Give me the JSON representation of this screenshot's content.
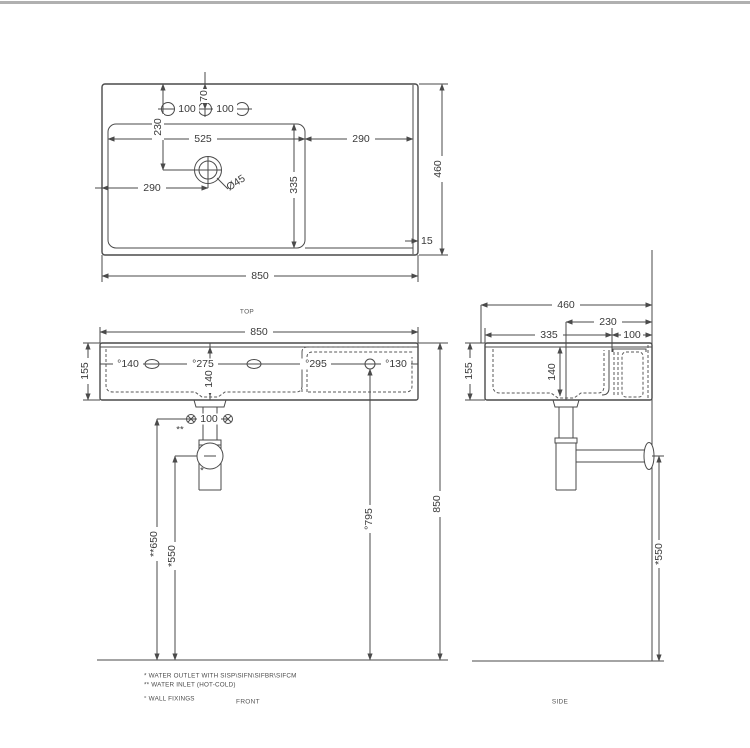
{
  "drawing": {
    "top_view": {
      "name": "TOP",
      "dims": {
        "tap_offset": "70",
        "tap_pitch_left": "100",
        "tap_pitch_right": "100",
        "drain_from_rear": "230",
        "bowl_width": "525",
        "deck_width": "290",
        "drain_from_left": "290",
        "drain_dia": "Ø45",
        "bowl_depth": "335",
        "overall_depth": "460",
        "rim": "15",
        "overall_width": "850"
      }
    },
    "front_view": {
      "name": "FRONT",
      "dims": {
        "overall_width": "850",
        "height": "155",
        "fix_left": "°140",
        "fix_pitch_left": "°275",
        "drain_drop": "140",
        "fix_pitch_right": "°295",
        "fix_right": "°130",
        "inlet_pitch": "100",
        "inlet_mark": "**",
        "outlet_mark": "*",
        "inlet_height": "**650",
        "outlet_height": "*550",
        "fix_height": "°795",
        "overall_height": "850"
      }
    },
    "side_view": {
      "name": "SIDE",
      "dims": {
        "overall_depth": "460",
        "drain_from_wall": "230",
        "bowl_depth": "335",
        "deck_depth": "100",
        "height": "155",
        "drain_drop": "140",
        "outlet_height": "*550"
      }
    },
    "legend": {
      "outlet": "*  WATER OUTLET WITH SISP\\SIFN\\SIFBR\\SIFCM",
      "inlet": "** WATER INLET  (HOT-COLD)",
      "fixings": "° WALL FIXINGS"
    }
  }
}
